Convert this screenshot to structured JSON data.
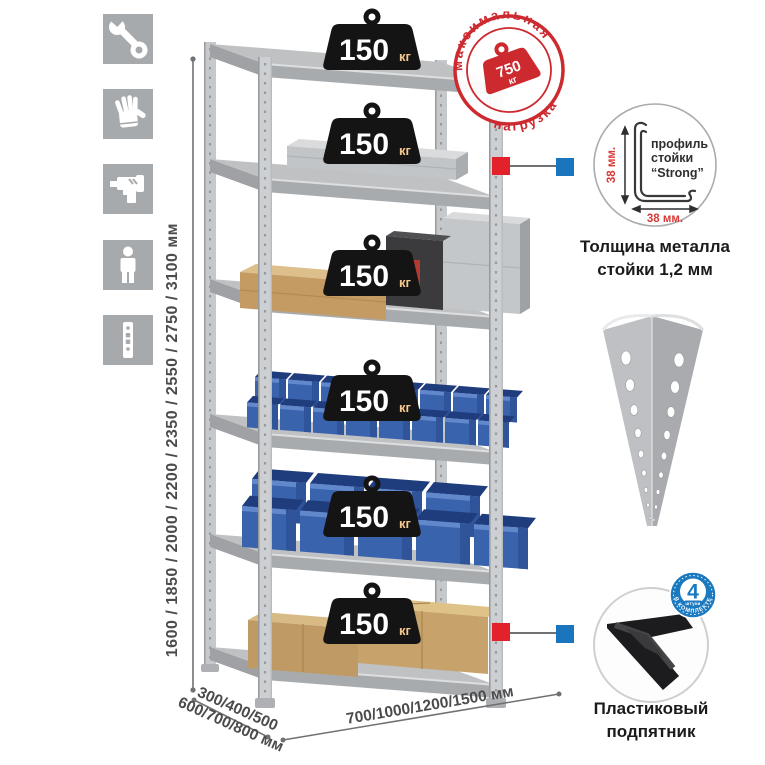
{
  "icon_strip": {
    "items": [
      {
        "name": "wrench"
      },
      {
        "name": "gloves"
      },
      {
        "name": "drill"
      },
      {
        "name": "person"
      },
      {
        "name": "rack-post"
      }
    ]
  },
  "height_dimension": {
    "label": "1600 / 1850 / 2000 / 2200 / 2350 / 2550 / 2750 / 3100 мм"
  },
  "rack": {
    "shelf_badges": {
      "unit": "кг",
      "items": [
        {
          "value": "150"
        },
        {
          "value": "150"
        },
        {
          "value": "150"
        },
        {
          "value": "150"
        },
        {
          "value": "150"
        },
        {
          "value": "150"
        }
      ]
    }
  },
  "max_load_stamp": {
    "arc_top": "максимальная",
    "arc_bottom": "нагрузка",
    "value": "750",
    "unit": "кг"
  },
  "profile_detail": {
    "label_line1": "профиль",
    "label_line2": "стойки",
    "label_line3": "“Strong”",
    "dim_vertical": "38 мм.",
    "dim_horizontal": "38 мм.",
    "caption_line1": "Толщина металла",
    "caption_line2": "стойки 1,2 мм"
  },
  "foot_detail": {
    "badge_count": "4",
    "badge_sub": "штуки",
    "badge_arc": "в комплекте",
    "caption_line1": "Пластиковый",
    "caption_line2": "подпятник"
  },
  "base_dimensions": {
    "depth_line1": "300/400/500",
    "depth_line2": "600/700/800 мм",
    "width_label": "700/1000/1200/1500 мм"
  },
  "colors": {
    "accent_red": "#cd2a30",
    "marker_red": "#e3212b",
    "marker_blue": "#1b75bc",
    "bin_blue": "#3a63ad",
    "metal_gray": "#c6c8ca",
    "icon_tile_gray": "#a7aaac",
    "badge_black": "#141414",
    "cardboard": "#c39a62",
    "foot_badge_blue": "#1b79c0"
  }
}
